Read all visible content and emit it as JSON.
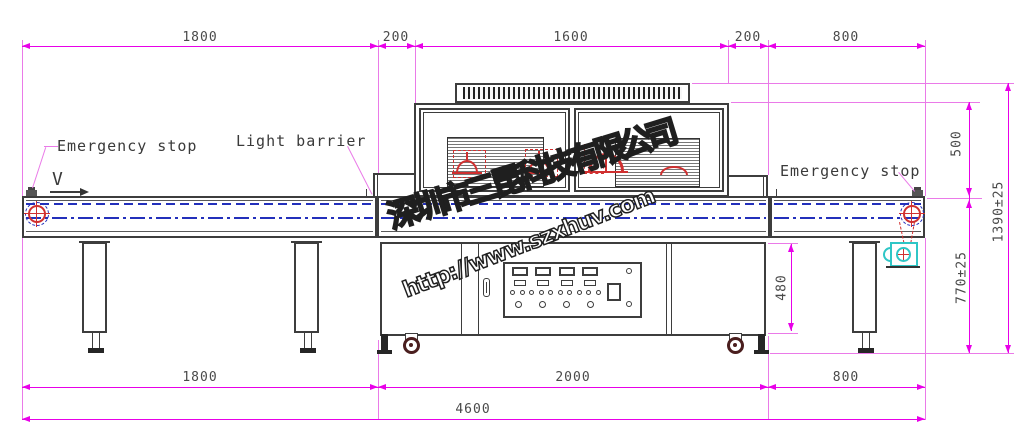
{
  "watermark": {
    "company": "深圳市三昆科技有限公司",
    "url": "http://www.szxhuv.com"
  },
  "labels": {
    "emergency_stop_left": "Emergency stop",
    "light_barrier": "Light barrier",
    "emergency_stop_right": "Emergency stop",
    "direction": "V"
  },
  "dims": {
    "top": [
      "1800",
      "200",
      "1600",
      "200",
      "800"
    ],
    "bottom": [
      "1800",
      "2000",
      "800"
    ],
    "overall": "4600",
    "right_upper": "500",
    "right_total": "1390±25",
    "right_lower": "770±25",
    "cabinet": "480"
  },
  "colors": {
    "dimension": "#e800e8",
    "machine_line": "#3d3d3d",
    "belt_blue": "#2330bb",
    "uv_red": "#d03030",
    "motor_cyan": "#2fc6c6"
  }
}
